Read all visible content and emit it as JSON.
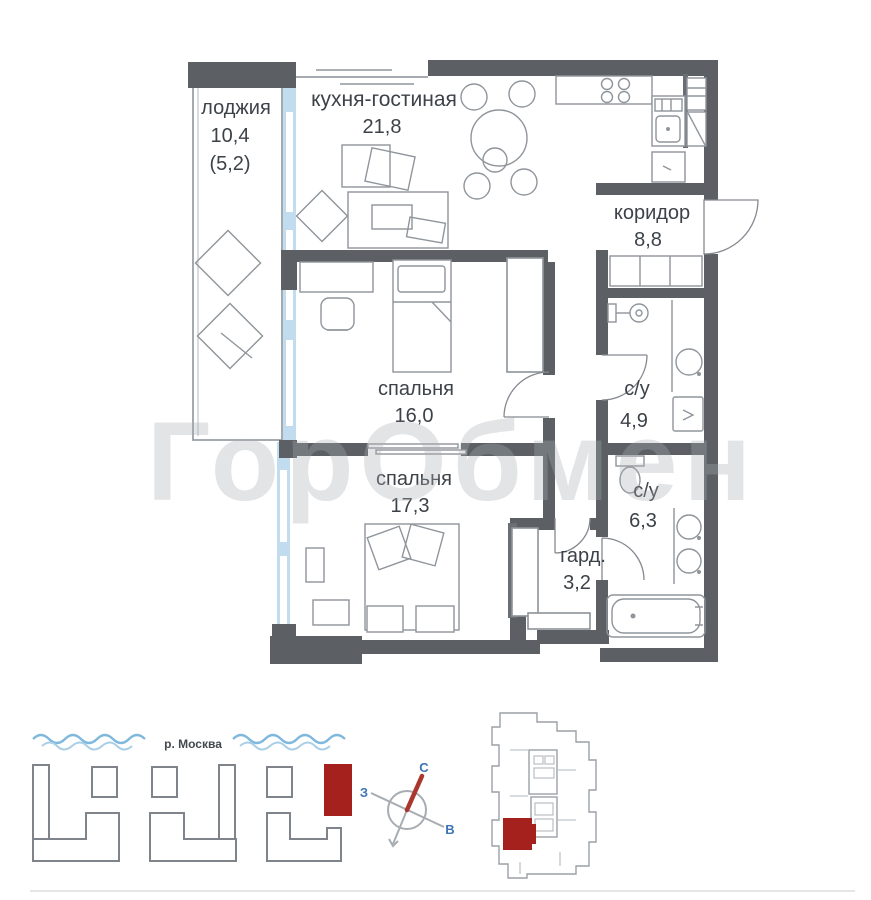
{
  "floor_plan": {
    "watermark": "ГорОбмен",
    "rooms": [
      {
        "name": "loggia",
        "label": "лоджия",
        "area": "10,4",
        "area_reduced": "(5,2)"
      },
      {
        "name": "kitchen-living",
        "label": "кухня-гостиная",
        "area": "21,8"
      },
      {
        "name": "corridor",
        "label": "коридор",
        "area": "8,8"
      },
      {
        "name": "bedroom-1",
        "label": "спальня",
        "area": "16,0"
      },
      {
        "name": "bathroom-1",
        "label": "с/у",
        "area": "4,9"
      },
      {
        "name": "bedroom-2",
        "label": "спальня",
        "area": "17,3"
      },
      {
        "name": "wardrobe",
        "label": "гард.",
        "area": "3,2"
      },
      {
        "name": "bathroom-2",
        "label": "с/у",
        "area": "6,3"
      }
    ]
  },
  "site_plan": {
    "river_label": "р. Москва"
  },
  "compass": {
    "north": "С",
    "west": "З",
    "east": "В"
  },
  "colors": {
    "wall": "#5c6065",
    "window_blue": "#c2dcef",
    "highlight_red": "#a5211e",
    "compass_blue": "#3e74b4",
    "compass_needle": "#aa372e",
    "watermark_gray": "#a9aeb4"
  }
}
